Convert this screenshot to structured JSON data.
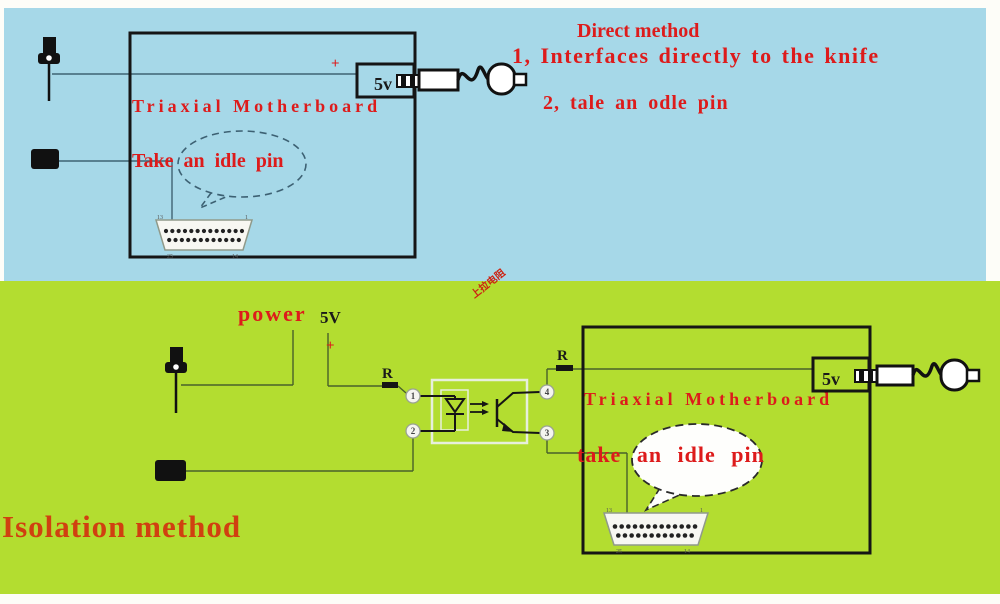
{
  "colors": {
    "blue_bg": "#a6d8e8",
    "green_bg": "#b3dd30",
    "red_text": "#dd1b1b",
    "red_orange_text": "#d04010",
    "ink": "#151515"
  },
  "direct": {
    "method_title": "Direct method",
    "note1": "1, Interfaces directly to the knife",
    "note2": "2, tale an odle pin",
    "motherboard": "Triaxial Motherboard",
    "bubble": "Take an idle pin",
    "psu": "5v",
    "plus": "+",
    "db25": {
      "tl": "13",
      "tr": "1",
      "bl": "25",
      "br": "14"
    }
  },
  "isolation": {
    "method_title": "Isolation method",
    "power": "power",
    "v5": "5V",
    "plus": "+",
    "r": "R",
    "pins": {
      "p1": "1",
      "p2": "2",
      "p3": "3",
      "p4": "4"
    },
    "motherboard": "Triaxial Motherboard",
    "bubble": "take an idle pin",
    "psu": "5v",
    "rotated_note": "上拉电阻",
    "db25": {
      "tl": "13",
      "tr": "1",
      "bl": "25",
      "br": "14"
    }
  }
}
